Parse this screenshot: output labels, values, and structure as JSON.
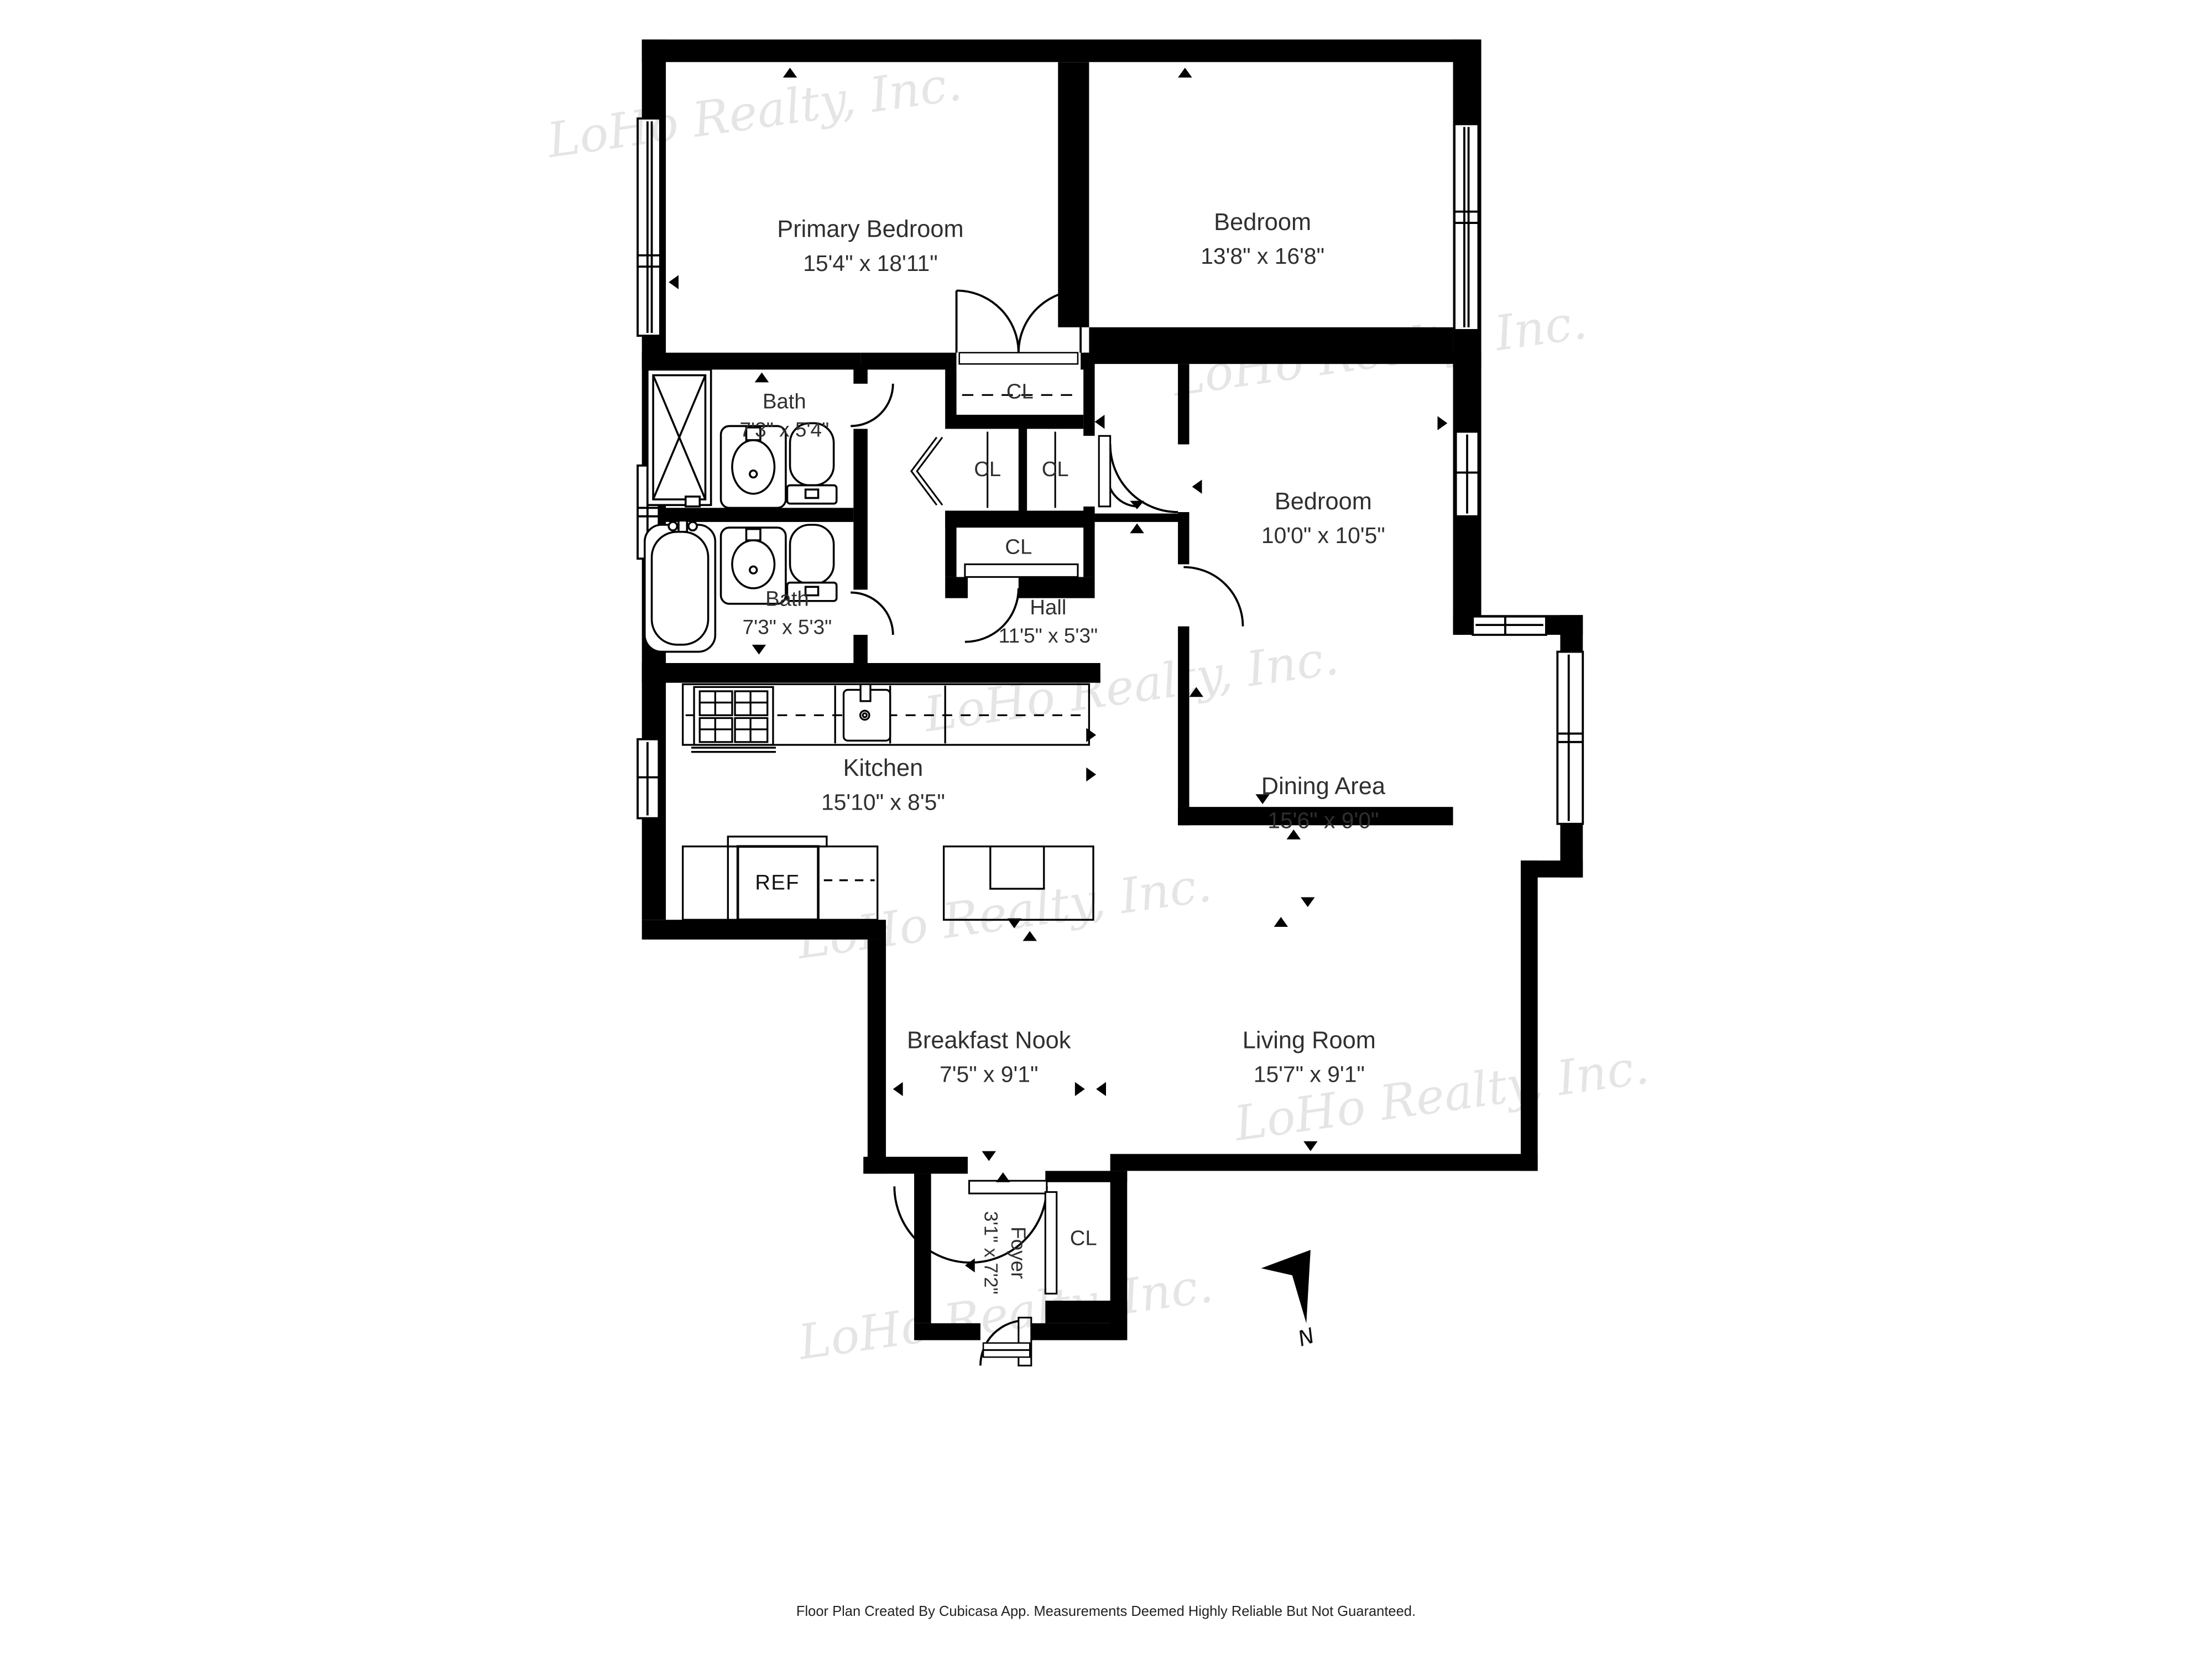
{
  "meta": {
    "type": "floor-plan",
    "colors": {
      "wall": "#000000",
      "label_text": "#2f2f2f",
      "watermark": "#e3e3e3",
      "background": "#ffffff"
    }
  },
  "rooms": [
    {
      "id": "primary-bedroom",
      "name": "Primary Bedroom",
      "dims": "15'4\" x 18'11\""
    },
    {
      "id": "bedroom-top",
      "name": "Bedroom",
      "dims": "13'8\" x 16'8\""
    },
    {
      "id": "bath-top",
      "name": "Bath",
      "dims": "7'3\" x 5'4\""
    },
    {
      "id": "bedroom-middle",
      "name": "Bedroom",
      "dims": "10'0\" x 10'5\""
    },
    {
      "id": "bath-bottom",
      "name": "Bath",
      "dims": "7'3\" x 5'3\""
    },
    {
      "id": "hall",
      "name": "Hall",
      "dims": "11'5\" x 5'3\""
    },
    {
      "id": "kitchen",
      "name": "Kitchen",
      "dims": "15'10\" x 8'5\""
    },
    {
      "id": "dining-area",
      "name": "Dining Area",
      "dims": "15'6\" x 9'0\""
    },
    {
      "id": "breakfast-nook",
      "name": "Breakfast Nook",
      "dims": "7'5\" x 9'1\""
    },
    {
      "id": "living-room",
      "name": "Living Room",
      "dims": "15'7\" x 9'1\""
    },
    {
      "id": "foyer",
      "name": "Foyer",
      "dims": "3'1\" x 7'2\""
    }
  ],
  "labels": {
    "closet": "CL",
    "refrigerator": "REF"
  },
  "compass": {
    "label": "N"
  },
  "watermark": {
    "text": "LoHo Realty, Inc."
  },
  "footer": {
    "disclaimer": "Floor Plan Created By Cubicasa App. Measurements Deemed Highly Reliable But Not Guaranteed."
  }
}
